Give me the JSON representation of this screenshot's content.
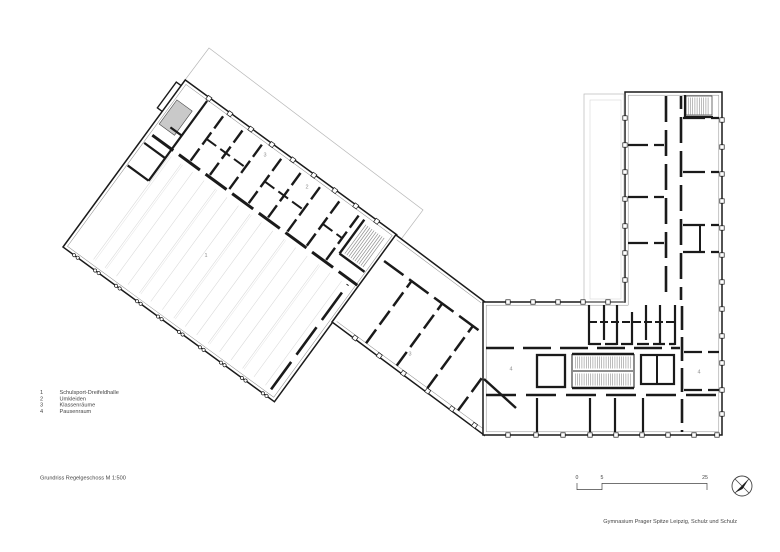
{
  "document": {
    "title": "Grundriss Regelgeschoss M 1:500",
    "attribution": "Gymnasium Prager Spitze Leipzig, Schulz und Schulz"
  },
  "legend": {
    "items": [
      {
        "num": "1",
        "label": "Schulsport-Dreifeldhalle"
      },
      {
        "num": "2",
        "label": "Umkleiden"
      },
      {
        "num": "3",
        "label": "Klassenräume"
      },
      {
        "num": "4",
        "label": "Pausenraum"
      }
    ]
  },
  "plan": {
    "room_labels": [
      {
        "text": "3"
      },
      {
        "text": "2"
      },
      {
        "text": "1"
      },
      {
        "text": "3"
      },
      {
        "text": "4"
      },
      {
        "text": "4"
      }
    ]
  },
  "scale_bar": {
    "ticks": [
      "0",
      "5",
      "25"
    ]
  },
  "icons": {
    "north_arrow": "compass-north-arrow"
  },
  "colors": {
    "wall": "#1a1a1a",
    "facade_inner": "#8a8a8a",
    "faint_outline": "#b8b8b8",
    "court_marking": "#d8d8d8",
    "stair_fill": "#c9c9c9",
    "room_label": "#8f8f8f",
    "text": "#454545",
    "background": "#ffffff"
  }
}
